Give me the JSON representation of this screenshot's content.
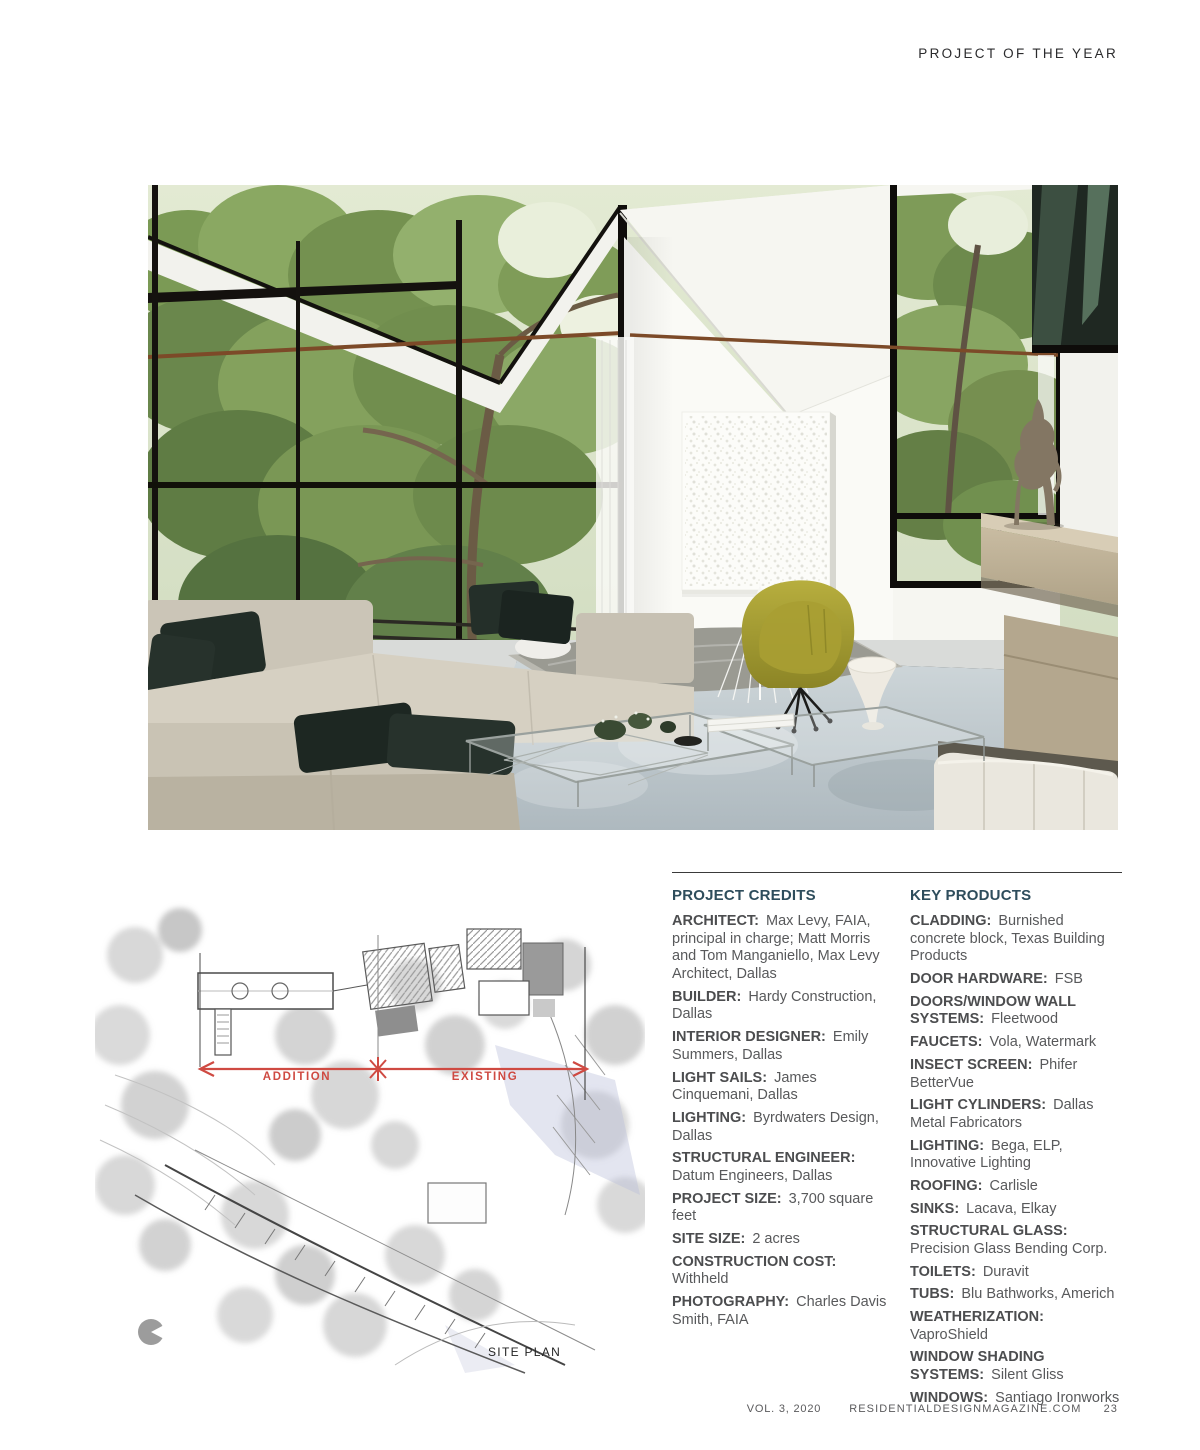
{
  "header": {
    "title": "PROJECT OF THE YEAR"
  },
  "site_plan": {
    "addition_label": "ADDITION",
    "existing_label": "EXISTING",
    "caption": "SITE PLAN"
  },
  "project_credits": {
    "title": "PROJECT CREDITS",
    "entries": [
      {
        "label": "ARCHITECT:",
        "value": "Max Levy, FAIA, principal in charge; Matt Morris and Tom Manganiello, Max Levy Architect, Dallas"
      },
      {
        "label": "BUILDER:",
        "value": "Hardy Construction, Dallas"
      },
      {
        "label": "INTERIOR DESIGNER:",
        "value": "Emily Summers, Dallas"
      },
      {
        "label": "LIGHT SAILS:",
        "value": "James Cinquemani, Dallas"
      },
      {
        "label": "LIGHTING:",
        "value": "Byrdwaters Design, Dallas"
      },
      {
        "label": "STRUCTURAL ENGINEER:",
        "value": "Datum Engineers, Dallas"
      },
      {
        "label": "PROJECT SIZE:",
        "value": "3,700 square feet"
      },
      {
        "label": "SITE SIZE:",
        "value": "2 acres"
      },
      {
        "label": "CONSTRUCTION COST:",
        "value": "Withheld"
      },
      {
        "label": "PHOTOGRAPHY:",
        "value": "Charles Davis Smith, FAIA"
      }
    ]
  },
  "key_products": {
    "title": "KEY PRODUCTS",
    "entries": [
      {
        "label": "CLADDING:",
        "value": "Burnished concrete block, Texas Building Products"
      },
      {
        "label": "DOOR HARDWARE:",
        "value": "FSB"
      },
      {
        "label": "DOORS/WINDOW WALL SYSTEMS:",
        "value": "Fleetwood"
      },
      {
        "label": "FAUCETS:",
        "value": "Vola, Watermark"
      },
      {
        "label": "INSECT SCREEN:",
        "value": "Phifer BetterVue"
      },
      {
        "label": "LIGHT CYLINDERS:",
        "value": "Dallas Metal Fabricators"
      },
      {
        "label": "LIGHTING:",
        "value": "Bega, ELP, Innovative Lighting"
      },
      {
        "label": "ROOFING:",
        "value": "Carlisle"
      },
      {
        "label": "SINKS:",
        "value": "Lacava, Elkay"
      },
      {
        "label": "STRUCTURAL GLASS:",
        "value": "Precision Glass Bending Corp."
      },
      {
        "label": "TOILETS:",
        "value": "Duravit"
      },
      {
        "label": "TUBS:",
        "value": "Blu Bathworks, Americh"
      },
      {
        "label": "WEATHERIZATION:",
        "value": "VaproShield"
      },
      {
        "label": "WINDOW SHADING SYSTEMS:",
        "value": "Silent Gliss"
      },
      {
        "label": "WINDOWS:",
        "value": "Santiago Ironworks"
      }
    ]
  },
  "footer": {
    "volume": "VOL. 3, 2020",
    "website": "RESIDENTIALDESIGNMAGAZINE.COM",
    "page_number": "23"
  },
  "colors": {
    "accent_red": "#cf4a42",
    "heading_teal": "#2e4d5c",
    "body_gray": "#58595b",
    "label_gray": "#4c4d4f"
  }
}
